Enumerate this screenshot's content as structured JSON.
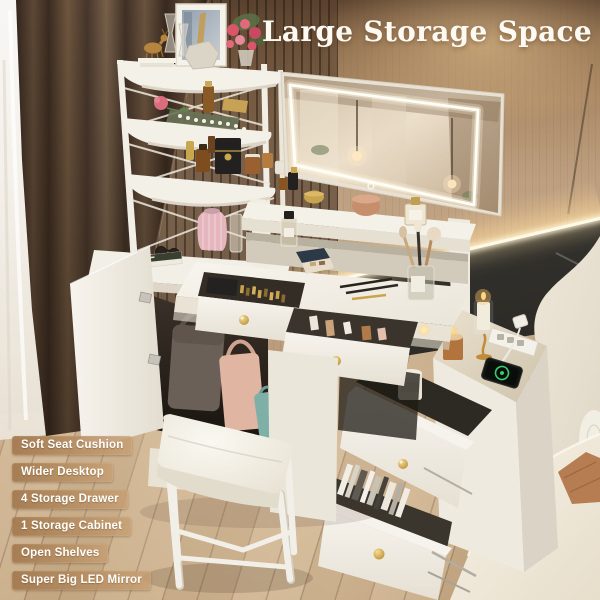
{
  "headline": "Large Storage Space",
  "badges": [
    {
      "label": "Soft Seat Cushion"
    },
    {
      "label": "Wider Desktop"
    },
    {
      "label": "4 Storage Drawer"
    },
    {
      "label": "1 Storage Cabinet"
    },
    {
      "label": "Open Shelves"
    },
    {
      "label": "Super Big LED Mirror"
    }
  ],
  "colors": {
    "headline_text": "#fdfaf4",
    "badge_tan": "#b08a5d",
    "wall_wood": "#b59677",
    "dark_wainscot": "#2c2a25",
    "led_white": "#fff9e8",
    "floor_oak": "#c6a983",
    "furniture_white": "#f2efe7",
    "knob_gold": "#c8962f",
    "curtain_brown": "#52402f",
    "bedding_cream": "#efe9dc",
    "phone_charging_green": "#35cf6b",
    "vase_pink": "#e5b6bd"
  }
}
